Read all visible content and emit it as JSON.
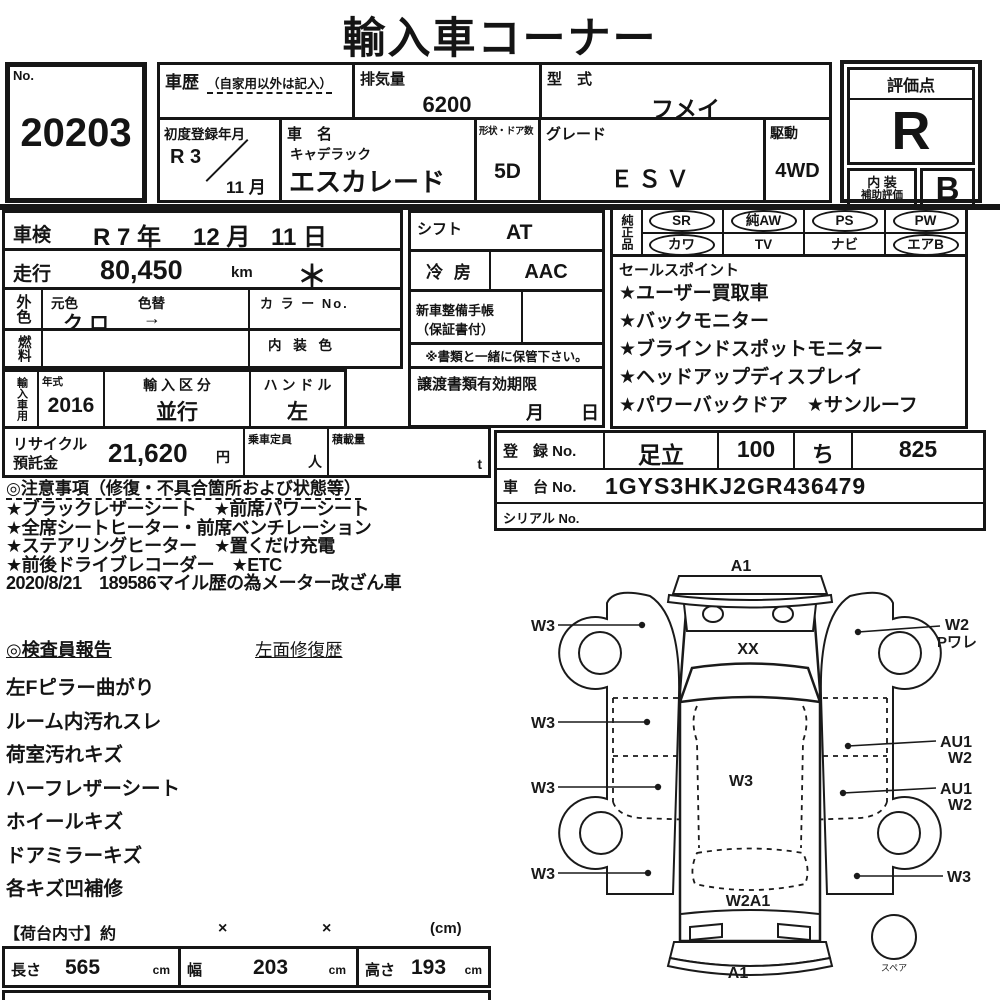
{
  "title": "輸入車コーナー",
  "no_box": {
    "label": "No.",
    "value": "20203"
  },
  "top": {
    "history_label": "車歴",
    "history_note": "（自家用以外は記入）",
    "displacement_label": "排気量",
    "displacement_value": "6200",
    "model_label": "型　式",
    "model_value": "フメイ",
    "first_reg_label": "初度登録年月",
    "first_reg_year": "R 3",
    "first_reg_slash": "／",
    "first_reg_month": "11 月",
    "name_label": "車　名",
    "maker": "キャデラック",
    "name_value": "エスカレード",
    "doors_label": "形状・ドア数",
    "doors_value": "5D",
    "grade_label": "グレード",
    "grade_value": "ＥＳＶ",
    "drive_label": "駆動",
    "drive_value": "4WD"
  },
  "rating": {
    "header": "評価点",
    "score": "R",
    "interior_line1": "内 装",
    "interior_line2": "補助評価",
    "interior_score": "B"
  },
  "left": {
    "shaken_label": "車検",
    "shaken_year": "R 7 年",
    "shaken_month": "12 月",
    "shaken_day": "11 日",
    "mileage_label": "走行",
    "mileage_value": "80,450",
    "mileage_unit": "km",
    "mileage_mark": "＊",
    "ext_color_label": "外色",
    "orig_color_label": "元色",
    "color_change_label": "色替",
    "orig_color_value": "クロ",
    "color_change_value": "→",
    "color_no_label": "カ ラ ー No.",
    "fuel_label": "燃料",
    "interior_color_label": "内 装 色",
    "import_vertical_label": "輸入車用",
    "year_label": "年式",
    "year_value": "2016",
    "import_class_label": "輸 入 区 分",
    "import_class_value": "並行",
    "handle_label": "ハ ン ド ル",
    "handle_value": "左",
    "recycle_label1": "リサイクル",
    "recycle_label2": "預託金",
    "recycle_value": "21,620",
    "recycle_unit": "円",
    "capacity_label": "乗車定員",
    "capacity_unit": "人",
    "load_label": "積載量",
    "load_unit": "t"
  },
  "middle": {
    "shift_label": "シフト",
    "shift_value": "AT",
    "ac_label": "冷 房",
    "ac_value": "AAC",
    "maint_label1": "新車整備手帳",
    "maint_label2": "（保証書付）",
    "keep_note": "※書類と一緒に保管下さい。",
    "transfer_label": "譲渡書類有効期限",
    "transfer_month": "月",
    "transfer_day": "日"
  },
  "equipment": {
    "label": "純正品",
    "cells": [
      {
        "label": "SR",
        "circled": true
      },
      {
        "label": "純AW",
        "circled": true
      },
      {
        "label": "PS",
        "circled": true
      },
      {
        "label": "PW",
        "circled": true
      },
      {
        "label": "カワ",
        "circled": true
      },
      {
        "label": "TV",
        "circled": false
      },
      {
        "label": "ナビ",
        "circled": false
      },
      {
        "label": "エアB",
        "circled": true
      }
    ]
  },
  "sales": {
    "header": "セールスポイント",
    "items": [
      "★ユーザー買取車",
      "★バックモニター",
      "★ブラインドスポットモニター",
      "★ヘッドアップディスプレイ",
      "★パワーバックドア　★サンルーフ"
    ]
  },
  "registration": {
    "reg_label": "登　録 No.",
    "reg_area": "足立",
    "reg_class": "100",
    "reg_kana": "ち",
    "reg_number": "825",
    "chassis_label": "車　台 No.",
    "chassis_value": "1GYS3HKJ2GR436479",
    "serial_label": "シリアル No."
  },
  "notes": {
    "header": "◎注意事項（修復・不具合箇所および状態等）",
    "lines": [
      "★ブラックレザーシート　★前席パワーシート",
      "★全席シートヒーター・前席ベンチレーション",
      "★ステアリングヒーター　★置くだけ充電",
      "★前後ドライブレコーダー　★ETC",
      "2020/8/21　189586マイル歴の為メーター改ざん車"
    ]
  },
  "inspector": {
    "header": "◎検査員報告",
    "repair_history": "左面修復歴",
    "lines": [
      "左Fピラー曲がり",
      "ルーム内汚れスレ",
      "荷室汚れキズ",
      "ハーフレザーシート",
      "ホイールキズ",
      "ドアミラーキズ",
      "各キズ凹補修"
    ]
  },
  "cargo": {
    "header": "【荷台内寸】約",
    "times1": "×",
    "times2": "×",
    "unit_note": "(cm)",
    "length_label": "長さ",
    "length_value": "565",
    "length_unit": "cm",
    "width_label": "幅",
    "width_value": "203",
    "width_unit": "cm",
    "height_label": "高さ",
    "height_value": "193",
    "height_unit": "cm"
  },
  "diagram": {
    "front_label": "A1",
    "hood_label": "XX",
    "roof_label": "W3",
    "rear_window_label": "W2A1",
    "rear_label": "A1",
    "spare_label": "スペア",
    "left1": "W3",
    "left2": "W3",
    "left3": "W3",
    "left4": "W3",
    "right1a": "W2",
    "right1b": "Pワレ",
    "right2a": "AU1",
    "right2b": "W2",
    "right3a": "AU1",
    "right3b": "W2",
    "right4": "W3"
  }
}
